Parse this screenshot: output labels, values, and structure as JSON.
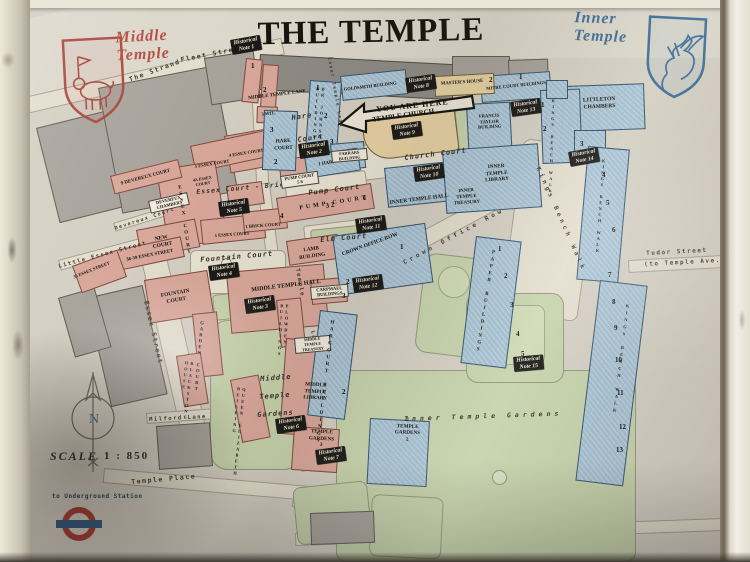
{
  "title": "THE TEMPLE",
  "crests": {
    "middle": {
      "label": "Middle\nTemple",
      "color": "#b5473c"
    },
    "inner": {
      "label": "Inner\nTemple",
      "color": "#3c6e96"
    }
  },
  "arrow_label": "YOU ARE HERE",
  "legend": {
    "scale_label": "SCALE",
    "scale_value": "1 : 850",
    "underground_label": "to Underground Station",
    "compass_letter": "N"
  },
  "colors": {
    "middle_temple_pink": "#d9a79a",
    "inner_temple_blue": "#a3bfd0",
    "church_tan": "#e6d1a2",
    "garden_green": "#c6d2ab",
    "note_bg": "#1a1916",
    "roundel_red": "#a8392f",
    "roundel_blue": "#33567e"
  },
  "map_labels": [
    {
      "text": "The Strand",
      "x": 128,
      "y": 76,
      "rot": -20,
      "kind": "street"
    },
    {
      "text": "Fleet Street",
      "x": 180,
      "y": 56,
      "rot": -11,
      "kind": "street"
    },
    {
      "text": "Little Essex Street",
      "x": 58,
      "y": 264,
      "rot": -15,
      "kind": "street",
      "fs": 5.5
    },
    {
      "text": "Essex Street",
      "x": 150,
      "y": 300,
      "rot": 77,
      "kind": "street"
    },
    {
      "text": "Devereux Court",
      "x": 114,
      "y": 226,
      "rot": -18,
      "kind": "street",
      "fs": 5
    },
    {
      "text": "Milford Lane",
      "x": 149,
      "y": 417,
      "rot": -3,
      "kind": "street",
      "fs": 5.5
    },
    {
      "text": "Temple Place",
      "x": 131,
      "y": 478,
      "rot": -5,
      "kind": "street"
    },
    {
      "text": "Tudor Street",
      "x": 646,
      "y": 250,
      "rot": -3,
      "kind": "street",
      "fs": 6
    },
    {
      "text": "(to Temple Ave.)",
      "x": 644,
      "y": 261,
      "rot": -3,
      "kind": "street",
      "fs": 6
    },
    {
      "text": "Inner Temple Lane",
      "x": 331,
      "y": 57,
      "rot": 80,
      "kind": "street",
      "fs": 4.5
    },
    {
      "text": "Temple",
      "x": 300,
      "y": 268,
      "rot": 80,
      "kind": "street",
      "fs": 5.5
    },
    {
      "text": "Lane",
      "x": 315,
      "y": 330,
      "rot": 78,
      "kind": "street",
      "fs": 5.5
    },
    {
      "text": "Crown Office Row",
      "x": 402,
      "y": 260,
      "rot": -28,
      "kind": "street",
      "fs": 6,
      "ls": 3.5
    },
    {
      "text": "Kings Bench Walk",
      "x": 541,
      "y": 166,
      "rot": 66,
      "kind": "street",
      "fs": 6,
      "ls": 3.5
    },
    {
      "text": "Fountain Court",
      "x": 200,
      "y": 256,
      "rot": -5,
      "kind": "court"
    },
    {
      "text": "Essex Court - Brick Court",
      "x": 196,
      "y": 188,
      "rot": -5,
      "kind": "court",
      "fs": 6.5
    },
    {
      "text": "Pump Court",
      "x": 308,
      "y": 189,
      "rot": -7,
      "kind": "court"
    },
    {
      "text": "Elm Court",
      "x": 320,
      "y": 236,
      "rot": -5,
      "kind": "court"
    },
    {
      "text": "Church Court",
      "x": 404,
      "y": 154,
      "rot": -7,
      "kind": "court"
    },
    {
      "text": "Hare",
      "x": 291,
      "y": 114,
      "rot": -8,
      "kind": "court"
    },
    {
      "text": "Court",
      "x": 297,
      "y": 136,
      "rot": -8,
      "kind": "court"
    },
    {
      "text": "Middle",
      "x": 260,
      "y": 375,
      "rot": -4,
      "kind": "court"
    },
    {
      "text": "Temple",
      "x": 259,
      "y": 393,
      "rot": -4,
      "kind": "court"
    },
    {
      "text": "Gardens",
      "x": 257,
      "y": 411,
      "rot": -4,
      "kind": "court"
    },
    {
      "text": "Inner Temple Gardens",
      "x": 404,
      "y": 415,
      "rot": -2,
      "kind": "court",
      "fs": 6.5,
      "ls": 4
    },
    {
      "text": "MIDDLE TEMPLE LANE",
      "x": 242,
      "y": 97,
      "rot": -7,
      "kind": "building",
      "w": 70,
      "fs": 5
    },
    {
      "text": "3 MTL",
      "x": 258,
      "y": 112,
      "rot": -6,
      "kind": "building",
      "w": 20,
      "fs": 4.5
    },
    {
      "text": "4 ESSEX COURT",
      "x": 228,
      "y": 153,
      "rot": -9,
      "kind": "building",
      "w": 36,
      "fs": 4.5
    },
    {
      "text": "5 ESSEX COURT",
      "x": 194,
      "y": 164,
      "rot": -9,
      "kind": "building",
      "w": 36,
      "fs": 4.5
    },
    {
      "text": "4A ESSEX\nCOURT",
      "x": 190,
      "y": 178,
      "rot": -9,
      "kind": "building",
      "w": 24,
      "fs": 4.2
    },
    {
      "text": "1 ESSEX COURT",
      "x": 214,
      "y": 233,
      "rot": -4,
      "kind": "building",
      "w": 36,
      "fs": 4.5
    },
    {
      "text": "1 BRICK COURT",
      "x": 245,
      "y": 224,
      "rot": -4,
      "kind": "building",
      "w": 36,
      "fs": 4.5
    },
    {
      "text": "9 DEVEREUX COURT",
      "x": 116,
      "y": 183,
      "rot": -15,
      "kind": "building",
      "w": 60,
      "fs": 5
    },
    {
      "text": "NEW\nCOURT",
      "x": 146,
      "y": 238,
      "rot": -10,
      "kind": "building",
      "w": 30,
      "fs": 5.5
    },
    {
      "text": "36-39 ESSEX STREET",
      "x": 120,
      "y": 259,
      "rot": -11,
      "kind": "building",
      "w": 60,
      "fs": 4.8
    },
    {
      "text": "35 ESSEX STREET",
      "x": 72,
      "y": 275,
      "rot": -22,
      "kind": "building",
      "w": 40,
      "fs": 4.5
    },
    {
      "text": "FOUNTAIN\nCOURT",
      "x": 155,
      "y": 294,
      "rot": -10,
      "kind": "building",
      "w": 40,
      "fs": 5.5
    },
    {
      "text": "MIDDLE TEMPLE HALL",
      "x": 246,
      "y": 288,
      "rot": -7,
      "kind": "building",
      "w": 80,
      "fs": 6
    },
    {
      "text": "MIDDLE\nTEMPLE\nLIBRARY",
      "x": 298,
      "y": 381,
      "rot": 3,
      "kind": "building",
      "w": 36,
      "fs": 5.2
    },
    {
      "text": "TEMPLE\nGARDENS\n3",
      "x": 304,
      "y": 428,
      "rot": 3,
      "kind": "building",
      "w": 36,
      "fs": 5.2
    },
    {
      "text": "1\nTEMPLE\nGARDENS\n2",
      "x": 388,
      "y": 416,
      "rot": 2,
      "kind": "building",
      "w": 40,
      "fs": 5.2
    },
    {
      "text": "LAMB\nBUILDING",
      "x": 292,
      "y": 249,
      "rot": -8,
      "kind": "building",
      "w": 38,
      "fs": 5.2
    },
    {
      "text": "HARE\nCOURT",
      "x": 268,
      "y": 139,
      "rot": -3,
      "kind": "building",
      "w": 30,
      "fs": 5.2
    },
    {
      "text": "1 HARE COURT",
      "x": 315,
      "y": 163,
      "rot": -9,
      "kind": "building",
      "w": 42,
      "fs": 4.8
    },
    {
      "text": "PUMP COURT",
      "x": 296,
      "y": 206,
      "rot": -9,
      "kind": "building",
      "w": 76,
      "fs": 6,
      "ls": 3
    },
    {
      "text": "GOLDSMITH BUILDING",
      "x": 342,
      "y": 87,
      "rot": -7,
      "kind": "building",
      "w": 56,
      "fs": 4.6
    },
    {
      "text": "MASTER'S HOUSE",
      "x": 438,
      "y": 82,
      "rot": -4,
      "kind": "building",
      "w": 48,
      "fs": 4.8
    },
    {
      "text": "MITRE COURT BUILDINGS",
      "x": 486,
      "y": 86,
      "rot": -6,
      "kind": "building",
      "w": 60,
      "fs": 4.6
    },
    {
      "text": "FRANCIS\nTAYLOR\nBUILDING",
      "x": 472,
      "y": 114,
      "rot": -3,
      "kind": "building",
      "w": 34,
      "fs": 4.6
    },
    {
      "text": "LITTLETON\nCHAMBERS",
      "x": 576,
      "y": 98,
      "rot": -3,
      "kind": "building",
      "w": 46,
      "fs": 5.5
    },
    {
      "text": "TEMPLE CHURCH",
      "x": 370,
      "y": 116,
      "rot": -8,
      "kind": "building",
      "w": 66,
      "fs": 7
    },
    {
      "text": "INNER TEMPLE HALL",
      "x": 382,
      "y": 201,
      "rot": -7,
      "kind": "building",
      "w": 74,
      "fs": 5.5
    },
    {
      "text": "INNER\nTEMPLE\nTREASURY",
      "x": 446,
      "y": 190,
      "rot": -4,
      "kind": "building",
      "w": 40,
      "fs": 4.8
    },
    {
      "text": "INNER\nTEMPLE\nLIBRARY",
      "x": 476,
      "y": 165,
      "rot": -4,
      "kind": "building",
      "w": 40,
      "fs": 5.2
    },
    {
      "text": "CROWN OFFICE ROW",
      "x": 338,
      "y": 253,
      "rot": -20,
      "kind": "building",
      "w": 66,
      "fs": 5.5
    },
    {
      "text": "DEVEREUX\nCHAMBERS",
      "x": 148,
      "y": 201,
      "rot": -13,
      "kind": "building-box",
      "w": 36
    },
    {
      "text": "PUMP COURT\n5   6",
      "x": 280,
      "y": 176,
      "rot": -8,
      "kind": "building-box",
      "w": 34
    },
    {
      "text": "CARPMAEL\nBUILDINGS",
      "x": 310,
      "y": 287,
      "rot": -5,
      "kind": "building-box",
      "w": 34
    },
    {
      "text": "MIDDLE\nTEMPLE\nTREASURY",
      "x": 294,
      "y": 338,
      "rot": -5,
      "kind": "building-box",
      "w": 32,
      "fs": 4
    },
    {
      "text": "FARRARS\nBUILDING",
      "x": 331,
      "y": 151,
      "rot": -5,
      "kind": "building-box",
      "w": 32,
      "fs": 4.3
    },
    {
      "text": "ESSEX COURT",
      "x": 176,
      "y": 186,
      "rot": -8,
      "kind": "vertical",
      "fs": 5,
      "ls": 1.5
    },
    {
      "text": "GARDEN COURT",
      "x": 199,
      "y": 320,
      "rot": 5,
      "kind": "vertical",
      "fs": 4.6
    },
    {
      "text": "BLACKSTONE\nHOUSE",
      "x": 184,
      "y": 360,
      "rot": 7,
      "kind": "vertical",
      "fs": 4.3
    },
    {
      "text": "QUEEN ELIZABETH\nBUILDING",
      "x": 236,
      "y": 386,
      "rot": 6,
      "kind": "vertical",
      "fs": 4.3
    },
    {
      "text": "PLOWDEN\nBUILDINGS",
      "x": 279,
      "y": 303,
      "rot": 3,
      "kind": "vertical",
      "fs": 4.3
    },
    {
      "text": "DR JOHNSON'S\nBUILDINGS",
      "x": 315,
      "y": 86,
      "rot": 4,
      "kind": "vertical",
      "fs": 4.3
    },
    {
      "text": "HARCOURT BUILDINGS",
      "x": 329,
      "y": 320,
      "rot": 7,
      "kind": "vertical",
      "fs": 5,
      "ls": 2
    },
    {
      "text": "PAPER BUILDINGS",
      "x": 490,
      "y": 250,
      "rot": 9,
      "kind": "vertical",
      "fs": 5,
      "ls": 2
    },
    {
      "text": "KINGS BENCH WALK",
      "x": 551,
      "y": 98,
      "rot": 2,
      "kind": "vertical",
      "fs": 4
    },
    {
      "text": "KINGS BENCH WALK",
      "x": 601,
      "y": 158,
      "rot": 4,
      "kind": "vertical",
      "fs": 4.3,
      "ls": 1
    },
    {
      "text": "KINGS BENCH WALK",
      "x": 625,
      "y": 303,
      "rot": 7,
      "kind": "vertical",
      "fs": 4.3,
      "ls": 2
    },
    {
      "text": "1",
      "x": 251,
      "y": 62,
      "kind": "number"
    },
    {
      "text": "2",
      "x": 263,
      "y": 86,
      "kind": "number"
    },
    {
      "text": "3",
      "x": 270,
      "y": 126,
      "kind": "number"
    },
    {
      "text": "2",
      "x": 274,
      "y": 158,
      "kind": "number"
    },
    {
      "text": "1",
      "x": 316,
      "y": 84,
      "kind": "number"
    },
    {
      "text": "2",
      "x": 324,
      "y": 112,
      "kind": "number"
    },
    {
      "text": "3",
      "x": 330,
      "y": 138,
      "kind": "number"
    },
    {
      "text": "2",
      "x": 489,
      "y": 76,
      "kind": "number"
    },
    {
      "text": "1",
      "x": 519,
      "y": 73,
      "kind": "number"
    },
    {
      "text": "4",
      "x": 280,
      "y": 212,
      "kind": "number"
    },
    {
      "text": "3  2",
      "x": 325,
      "y": 202,
      "rot": -9,
      "kind": "number"
    },
    {
      "text": "1",
      "x": 363,
      "y": 194,
      "kind": "number"
    },
    {
      "text": "1",
      "x": 400,
      "y": 243,
      "kind": "number"
    },
    {
      "text": "2",
      "x": 346,
      "y": 278,
      "kind": "number"
    },
    {
      "text": "3",
      "x": 342,
      "y": 292,
      "kind": "number"
    },
    {
      "text": "2",
      "x": 342,
      "y": 388,
      "kind": "number"
    },
    {
      "text": "1",
      "x": 498,
      "y": 245,
      "kind": "number"
    },
    {
      "text": "2",
      "x": 504,
      "y": 272,
      "kind": "number"
    },
    {
      "text": "3",
      "x": 510,
      "y": 301,
      "kind": "number"
    },
    {
      "text": "4",
      "x": 516,
      "y": 330,
      "kind": "number"
    },
    {
      "text": "5",
      "x": 521,
      "y": 350,
      "kind": "number"
    },
    {
      "text": "1",
      "x": 541,
      "y": 101,
      "kind": "number"
    },
    {
      "text": "2",
      "x": 543,
      "y": 125,
      "kind": "number"
    },
    {
      "text": "3",
      "x": 580,
      "y": 140,
      "kind": "number"
    },
    {
      "text": "4",
      "x": 602,
      "y": 171,
      "kind": "number"
    },
    {
      "text": "5",
      "x": 606,
      "y": 199,
      "kind": "number"
    },
    {
      "text": "6",
      "x": 612,
      "y": 226,
      "kind": "number"
    },
    {
      "text": "7",
      "x": 608,
      "y": 271,
      "kind": "number"
    },
    {
      "text": "8",
      "x": 612,
      "y": 298,
      "kind": "number"
    },
    {
      "text": "9",
      "x": 614,
      "y": 324,
      "kind": "number"
    },
    {
      "text": "10",
      "x": 615,
      "y": 356,
      "kind": "number"
    },
    {
      "text": "11",
      "x": 617,
      "y": 389,
      "kind": "number"
    },
    {
      "text": "12",
      "x": 619,
      "y": 423,
      "kind": "number"
    },
    {
      "text": "13",
      "x": 616,
      "y": 446,
      "kind": "number"
    },
    {
      "text": "Historical\nNote 1",
      "x": 230,
      "y": 40,
      "rot": -10,
      "kind": "note"
    },
    {
      "text": "Historical\nNote 2",
      "x": 298,
      "y": 144,
      "rot": -8,
      "kind": "note"
    },
    {
      "text": "Historical\nNote 3",
      "x": 244,
      "y": 299,
      "rot": -8,
      "kind": "note"
    },
    {
      "text": "Historical\nNote 4",
      "x": 208,
      "y": 266,
      "rot": -8,
      "kind": "note"
    },
    {
      "text": "Historical\nNote 5",
      "x": 218,
      "y": 202,
      "rot": -8,
      "kind": "note"
    },
    {
      "text": "Historical\nNote 6",
      "x": 275,
      "y": 419,
      "rot": -8,
      "kind": "note"
    },
    {
      "text": "Historical\nNote 7",
      "x": 315,
      "y": 450,
      "rot": -8,
      "kind": "note"
    },
    {
      "text": "Historical\nNote 8",
      "x": 405,
      "y": 78,
      "rot": -8,
      "kind": "note"
    },
    {
      "text": "Historical\nNote 9",
      "x": 391,
      "y": 125,
      "rot": -8,
      "kind": "note"
    },
    {
      "text": "Historical\nNote 10",
      "x": 413,
      "y": 167,
      "rot": -8,
      "kind": "note"
    },
    {
      "text": "Historical\nNote 11",
      "x": 355,
      "y": 219,
      "rot": -8,
      "kind": "note"
    },
    {
      "text": "Historical\nNote 12",
      "x": 352,
      "y": 278,
      "rot": -8,
      "kind": "note"
    },
    {
      "text": "Historical\nNote 13",
      "x": 510,
      "y": 102,
      "rot": -8,
      "kind": "note"
    },
    {
      "text": "Historical\nNote 14",
      "x": 568,
      "y": 152,
      "rot": -10,
      "kind": "note"
    },
    {
      "text": "Historical\nNote 15",
      "x": 513,
      "y": 357,
      "rot": -5,
      "kind": "note"
    }
  ]
}
